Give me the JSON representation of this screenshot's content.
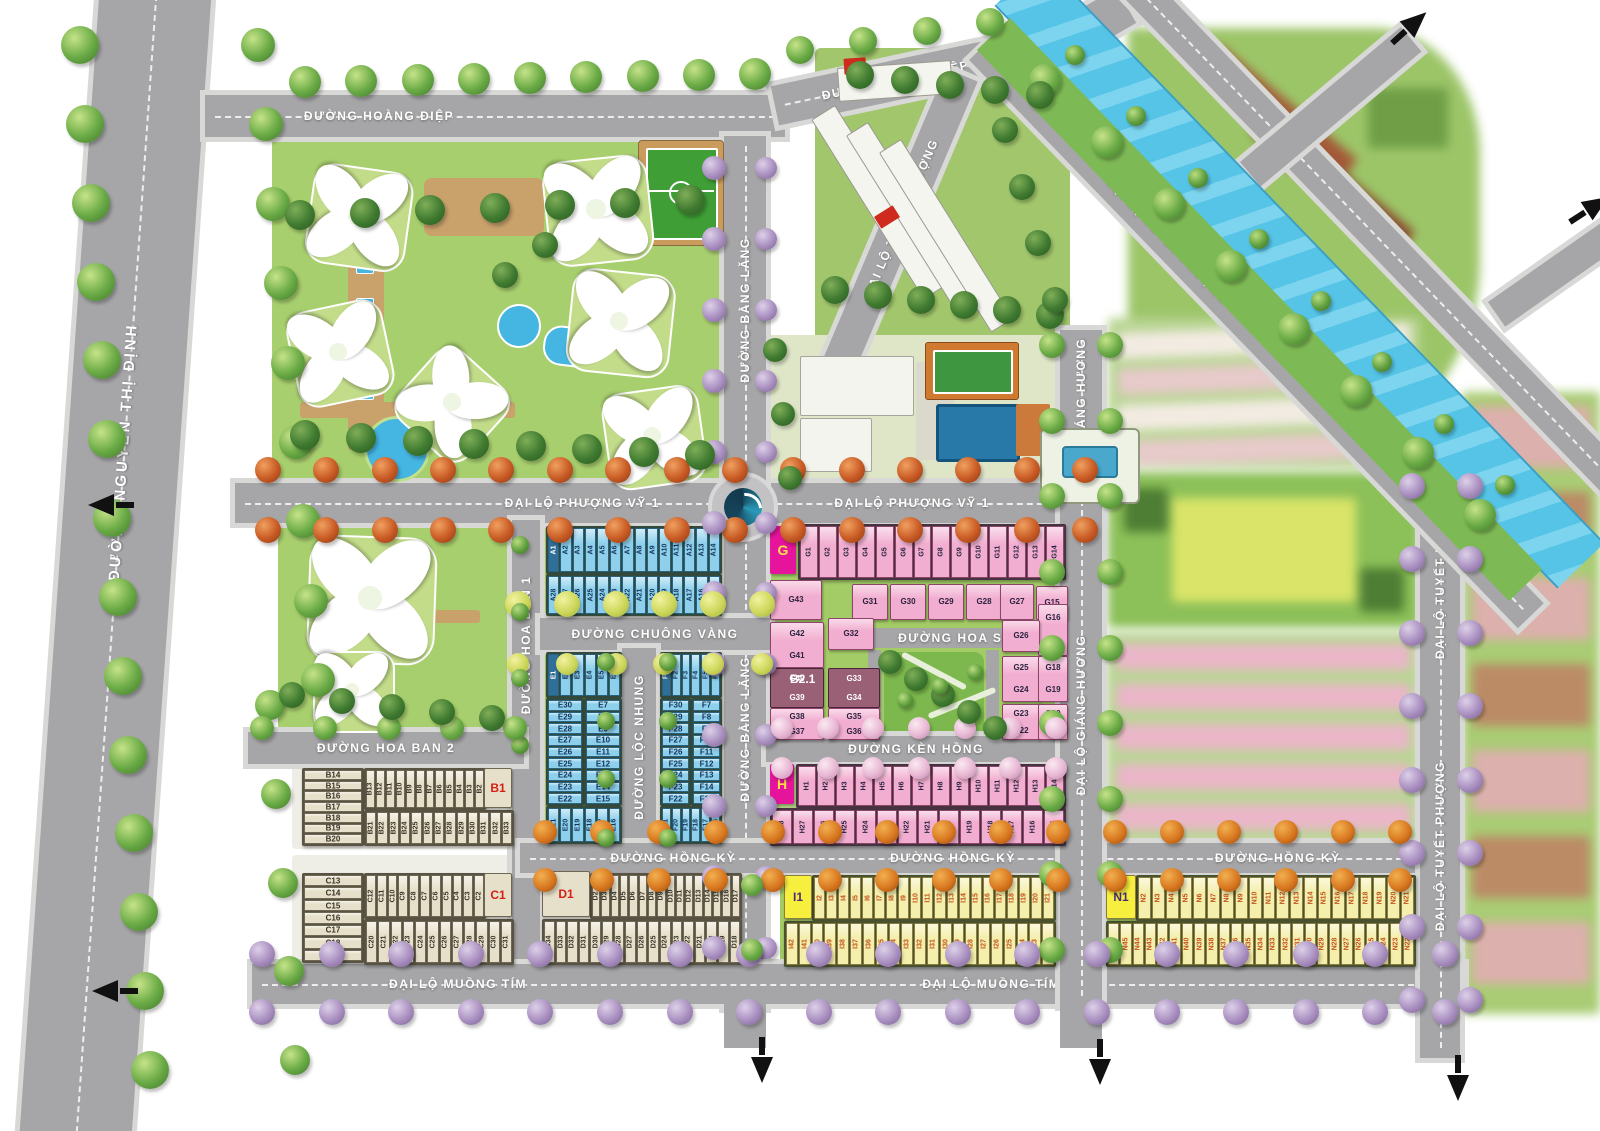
{
  "streets": {
    "nguyen_thi_dinh": "ĐƯỜNG NGUYỄN THỊ ĐỊNH",
    "hoang_diep": "ĐƯỜNG HOÀNG ĐIỆP",
    "bang_lang": "ĐƯỜNG BẰNG LĂNG",
    "phuong_vy_1": "ĐẠI LỘ PHƯỢNG VỸ 1",
    "hoa_ban_1": "ĐƯỜNG HOA BAN 1",
    "hoa_ban_2": "ĐƯỜNG HOA BAN 2",
    "chuong_vang": "ĐƯỜNG CHUÔNG VÀNG",
    "loc_nhung": "ĐƯỜNG LỘC NHUNG",
    "hoa_su": "ĐƯỜNG HOA SỮ",
    "ken_hong": "ĐƯỜNG KÈN HỒNG",
    "hong_ky": "ĐƯỜNG HỒNG KỲ",
    "muong_tim": "ĐẠI LỘ MUỒNG TÍM",
    "giang_huong": "ĐẠI LỘ GIÁNG HƯƠNG",
    "tuyet_phuong": "ĐẠI LỘ TUYẾT PHƯỢNG"
  },
  "blocks": {
    "A": {
      "row1": [
        "A1",
        "A2",
        "A3",
        "A4",
        "A5",
        "A6",
        "A7",
        "A8",
        "A9",
        "A10",
        "A11",
        "A12",
        "A13",
        "A14"
      ],
      "row2": [
        "A28",
        "A27",
        "A26",
        "A25",
        "A24",
        "A23",
        "A22",
        "A21",
        "A20",
        "A19",
        "A18",
        "A17",
        "A16",
        "A15"
      ]
    },
    "B": {
      "marker": "B1",
      "left_col": [
        "B14",
        "B15",
        "B16",
        "B17",
        "B18",
        "B19",
        "B20"
      ],
      "row1": [
        "B13",
        "B12",
        "B11",
        "B10",
        "B9",
        "B8",
        "B7",
        "B6",
        "B5",
        "B4",
        "B3",
        "B2"
      ],
      "row2": [
        "B21",
        "B22",
        "B23",
        "B24",
        "B25",
        "B26",
        "B27",
        "B28",
        "B29",
        "B30",
        "B31",
        "B32",
        "B33"
      ]
    },
    "C": {
      "marker": "C1",
      "left_col": [
        "C13",
        "C14",
        "C15",
        "C16",
        "C17",
        "C18",
        "C19"
      ],
      "row1": [
        "C12",
        "C11",
        "C10",
        "C9",
        "C8",
        "C7",
        "C6",
        "C5",
        "C4",
        "C3",
        "C2"
      ],
      "row2": [
        "C20",
        "C21",
        "C22",
        "C23",
        "C24",
        "C25",
        "C26",
        "C27",
        "C28",
        "C29",
        "C30",
        "C31"
      ]
    },
    "D": {
      "marker": "D1",
      "row1": [
        "D2",
        "D3",
        "D4",
        "D5",
        "D6",
        "D7",
        "D8",
        "D9",
        "D10",
        "D11",
        "D12",
        "D13",
        "D14",
        "D15",
        "D16",
        "D17"
      ],
      "row2": [
        "D34",
        "D33",
        "D32",
        "D31",
        "D30",
        "D29",
        "D28",
        "D27",
        "D26",
        "D25",
        "D24",
        "D23",
        "D22",
        "D21",
        "D20",
        "D19",
        "D18"
      ]
    },
    "E": {
      "top": [
        "E1",
        "E2",
        "E3",
        "E4",
        "E5",
        "E6"
      ],
      "left_col": [
        "E30",
        "E29",
        "E28",
        "E27",
        "E26",
        "E25",
        "E24",
        "E23",
        "E22"
      ],
      "right_col": [
        "E7",
        "E8",
        "E9",
        "E10",
        "E11",
        "E12",
        "E13",
        "E14",
        "E15"
      ],
      "bottom": [
        "E21",
        "E20",
        "E19",
        "E18",
        "E17",
        "E16"
      ]
    },
    "F": {
      "top": [
        "F1",
        "F2",
        "F3",
        "F4",
        "F5",
        "F6"
      ],
      "left_col": [
        "F30",
        "F29",
        "F28",
        "F27",
        "F26",
        "F25",
        "F24",
        "F23",
        "F22"
      ],
      "right_col": [
        "F7",
        "F8",
        "F9",
        "F10",
        "F11",
        "F12",
        "F13",
        "F14",
        "F15"
      ],
      "bottom": [
        "F21",
        "F20",
        "F19",
        "F18",
        "F17",
        "F16"
      ]
    },
    "G": {
      "marker": "G",
      "sub": "B2.1",
      "row1": [
        "G1",
        "G2",
        "G3",
        "G4",
        "G5",
        "G6",
        "G7",
        "G8",
        "G9",
        "G10",
        "G11",
        "G12",
        "G13",
        "G14"
      ],
      "row2": [
        "G43",
        "G31",
        "G30",
        "G29",
        "G28",
        "G27",
        "G15"
      ],
      "left_pairs": [
        [
          "G42",
          "G41"
        ],
        [
          "G40",
          "G39"
        ],
        [
          "G38",
          "G37"
        ]
      ],
      "mid": [
        [
          "G32"
        ],
        [
          "G33",
          "G34"
        ],
        [
          "G35",
          "G36"
        ]
      ],
      "right": [
        [
          "G16",
          "G17"
        ],
        [
          "G26"
        ],
        [
          "G25",
          "G24"
        ],
        [
          "G18",
          "G19"
        ],
        [
          "G23",
          "G22"
        ],
        [
          "G20",
          "G21"
        ]
      ]
    },
    "H": {
      "marker": "H",
      "row1": [
        "H1",
        "H2",
        "H3",
        "H4",
        "H5",
        "H6",
        "H7",
        "H8",
        "H9",
        "H10",
        "H11",
        "H12",
        "H13",
        "H14"
      ],
      "row2": [
        "H28",
        "H27",
        "H26",
        "H25",
        "H24",
        "H23",
        "H22",
        "H21",
        "H20",
        "H19",
        "H18",
        "H17",
        "H16",
        "H15"
      ]
    },
    "I": {
      "marker": "I1",
      "row1": [
        "I2",
        "I3",
        "I4",
        "I5",
        "I6",
        "I7",
        "I8",
        "I9",
        "I10",
        "I11",
        "I12",
        "I13",
        "I14",
        "I15",
        "I16",
        "I17",
        "I18",
        "I19",
        "I20",
        "I21"
      ],
      "row2": [
        "I42",
        "I41",
        "I40",
        "I39",
        "I38",
        "I37",
        "I36",
        "I35",
        "I34",
        "I33",
        "I32",
        "I31",
        "I30",
        "I29",
        "I28",
        "I27",
        "I26",
        "I25",
        "I24",
        "I23",
        "I22"
      ]
    },
    "N": {
      "marker": "N1",
      "row1": [
        "N2",
        "N3",
        "N4",
        "N5",
        "N6",
        "N7",
        "N8",
        "N9",
        "N10",
        "N11",
        "N12",
        "N13",
        "N14",
        "N15",
        "N16",
        "N17",
        "N18",
        "N19",
        "N20",
        "N21"
      ],
      "row2": [
        "N46",
        "N45",
        "N44",
        "N43",
        "N42",
        "N41",
        "N40",
        "N39",
        "N38",
        "N37",
        "N36",
        "N35",
        "N34",
        "N33",
        "N32",
        "N31",
        "N30",
        "N29",
        "N28",
        "N27",
        "N26",
        "N25",
        "N24",
        "N23",
        "N22"
      ]
    }
  },
  "colors": {
    "road": "#a6a6a8",
    "canal": "#5ac6e8",
    "lawn": "#a8cf6e",
    "townhouse_blue": "#8ed0ec",
    "townhouse_pink": "#f2aed0",
    "townhouse_beige": "#e6dfc9",
    "townhouse_yellow": "#f4efad",
    "marker_magenta": "#e6149c",
    "marker_red_text": "#d42015",
    "marker_yellow": "#f7ef3e"
  }
}
